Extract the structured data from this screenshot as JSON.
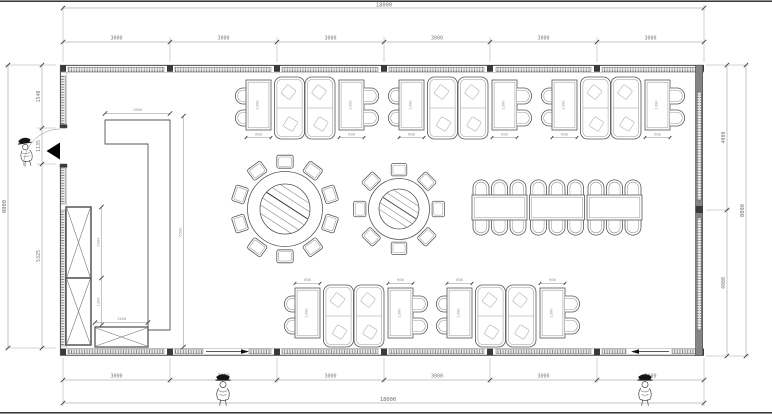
{
  "dims": {
    "top_total": "18000",
    "top_segments": [
      "3000",
      "3000",
      "3000",
      "3000",
      "3000",
      "3000"
    ],
    "bottom_segments": [
      "3000",
      "3000",
      "3000",
      "3000",
      "3000",
      "3000"
    ],
    "bottom_total": "18000",
    "left_total": "8000",
    "left_segments": [
      "1540",
      "1135",
      "5325"
    ],
    "right_segments": [
      "4000",
      "4000"
    ],
    "right_total": "8000",
    "partition_width": "1800",
    "partition_height": "6500",
    "cabinet_upper": "2000",
    "cabinet_lower": "1300",
    "low_cabinet_width": "1500",
    "table_width": "600",
    "table_length": "1300"
  },
  "furniture": {
    "booth_groups_top": 3,
    "booth_groups_bottom": 2,
    "round_table_large_seats": 10,
    "round_table_small_seats": 8,
    "banquet_table_segments": 3,
    "banquet_table_seats": 18,
    "tall_cabinet_sections": 2,
    "low_cabinets": 1,
    "person_figures": 3,
    "entry_doors": 1,
    "bottom_doors": 2
  },
  "colors": {
    "line": "#4a4a4a",
    "dim_line": "#8c8c8c",
    "dim_text": "#7a7a7a",
    "wall_dark": "#3a3a3a",
    "background": "#ffffff"
  }
}
